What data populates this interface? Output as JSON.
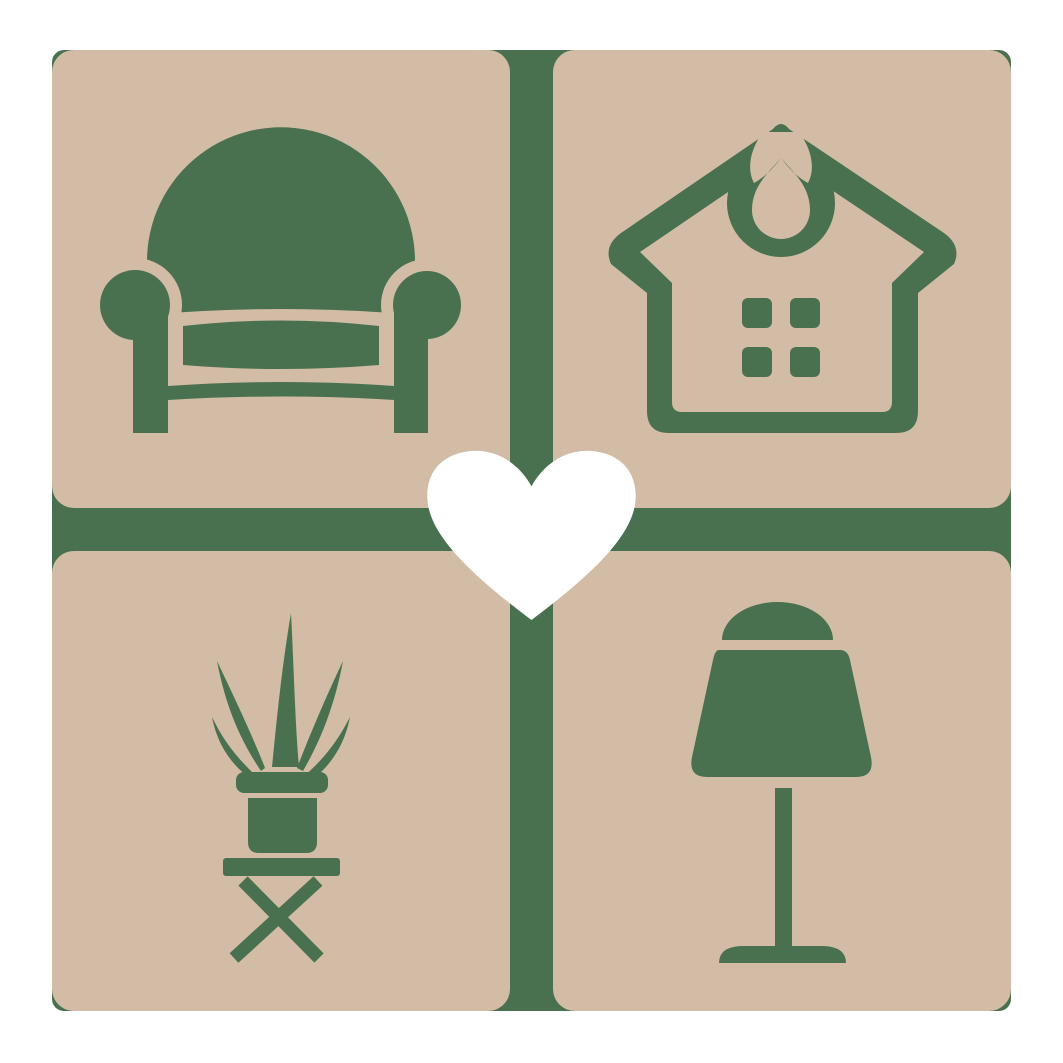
{
  "logo": {
    "type": "home-decor-logo",
    "description": "Four rounded tan tiles with green furniture icons (armchair, house, potted plant, table lamp) on a green backdrop, white heart at the center",
    "colors": {
      "background": "#ffffff",
      "tile": "#d3bca5",
      "icon_green": "#49714f",
      "heart": "#ffffff"
    },
    "tiles": [
      {
        "position": "top-left",
        "icon": "armchair-icon"
      },
      {
        "position": "top-right",
        "icon": "house-icon"
      },
      {
        "position": "bottom-left",
        "icon": "potted-plant-icon"
      },
      {
        "position": "bottom-right",
        "icon": "table-lamp-icon"
      }
    ],
    "center": {
      "icon": "heart-icon"
    }
  }
}
